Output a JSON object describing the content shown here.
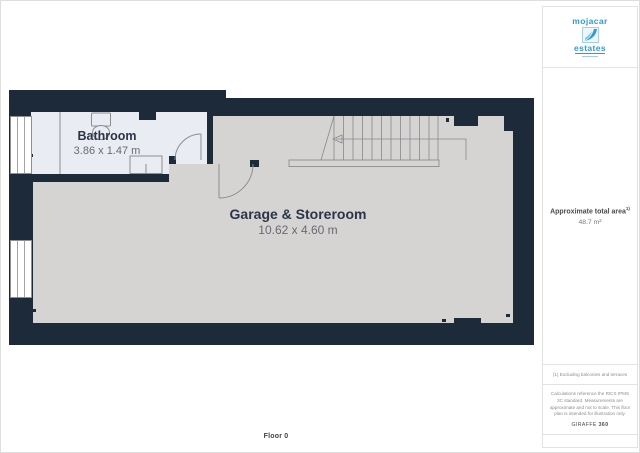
{
  "branding": {
    "logo_top": "mojacar",
    "logo_bottom": "estates"
  },
  "sidebar": {
    "area_label": "Approximate total area",
    "area_superscript": "1)",
    "area_value": "48.7 m²",
    "footnote": "(1) Excluding balconies and terraces",
    "disclaimer": "Calculations reference the RICS IPMS 3C standard. Measurements are approximate and not to scale. This floor plan is intended for illustration only.",
    "brand_name": "GIRAFFE",
    "brand_suffix": "360"
  },
  "floor_plan": {
    "floor_label": "Floor 0",
    "rooms": [
      {
        "name": "Bathroom",
        "dimensions": "3.86 x 1.47 m"
      },
      {
        "name": "Garage & Storeroom",
        "dimensions": "10.62 x 4.60 m"
      }
    ]
  },
  "colors": {
    "wall_navy": "#1d2a3a",
    "garage_floor": "#d5d4d2",
    "bathroom_floor": "#eaecf3",
    "logo_blue": "#2f9ad4",
    "label_dark": "#2b3547",
    "label_gray": "#676b72"
  }
}
